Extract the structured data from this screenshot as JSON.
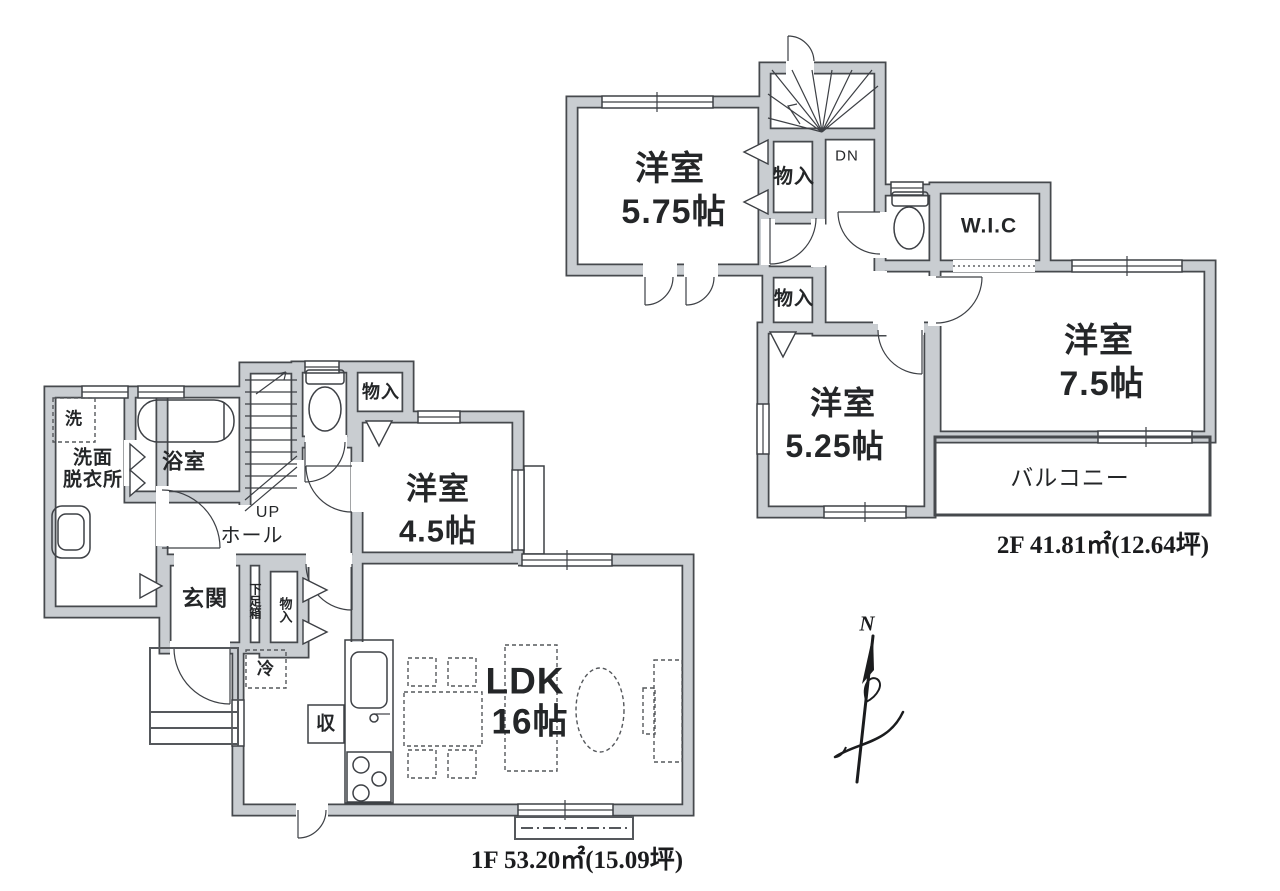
{
  "floor2": {
    "caption": "2F 41.81㎡(12.64坪)",
    "rooms": {
      "youshitsu575": {
        "line1": "洋室",
        "line2": "5.75帖"
      },
      "youshitsu75": {
        "line1": "洋室",
        "line2": "7.5帖"
      },
      "youshitsu525": {
        "line1": "洋室",
        "line2": "5.25帖"
      },
      "wic": {
        "label": "W.I.C"
      },
      "balcony": {
        "label": "バルコニー"
      },
      "monoire_upper": {
        "label": "物入"
      },
      "monoire_lower": {
        "label": "物入"
      },
      "stairs": {
        "label": "DN"
      }
    }
  },
  "floor1": {
    "caption": "1F 53.20㎡(15.09坪)",
    "rooms": {
      "ldk": {
        "line1": "LDK",
        "line2": "16帖"
      },
      "youshitsu45": {
        "line1": "洋室",
        "line2": "4.5帖"
      },
      "bathroom": {
        "label": "浴室"
      },
      "washroom": {
        "line1": "洗面",
        "line2": "脱衣所"
      },
      "washer": {
        "label": "洗"
      },
      "genkan": {
        "label": "玄関"
      },
      "getabako": {
        "label": "下足箱"
      },
      "monoire_genkan": {
        "label": "物入"
      },
      "monoire_hall": {
        "label": "物入"
      },
      "stairs": {
        "label": "UP"
      },
      "hall": {
        "label": "ホール"
      },
      "refrigerator": {
        "label": "冷"
      },
      "storage": {
        "label": "収"
      }
    }
  },
  "compass": {
    "label": "N"
  }
}
